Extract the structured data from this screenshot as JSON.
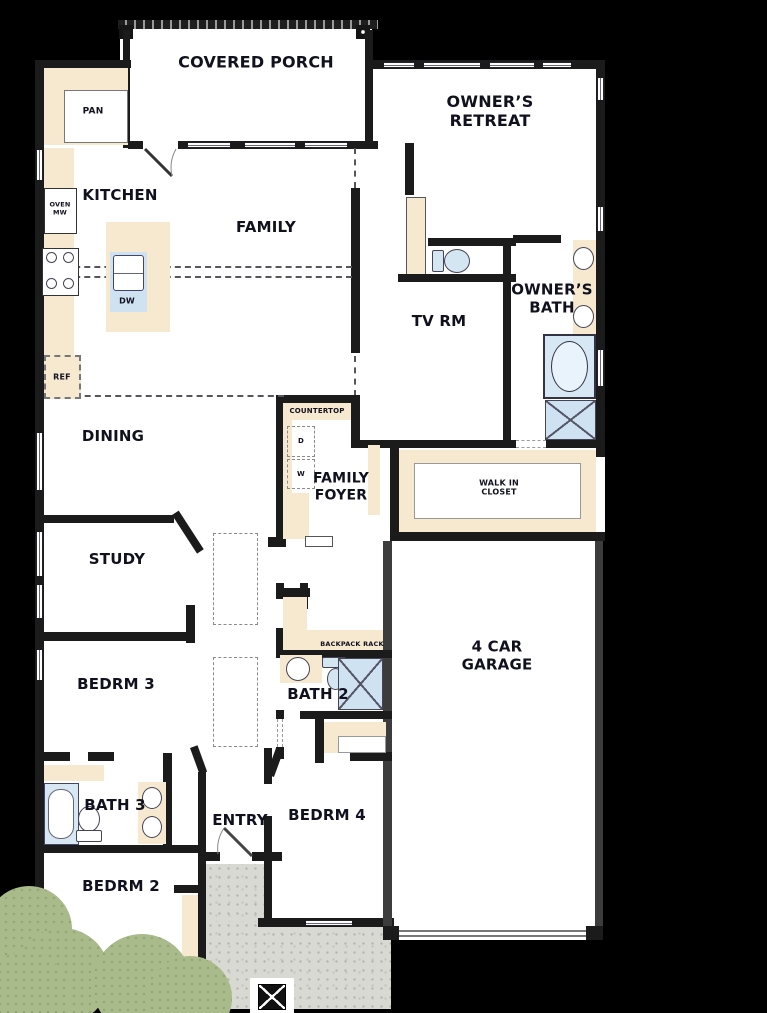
{
  "rooms": {
    "covered_porch": "COVERED PORCH",
    "owners_retreat": "OWNER’S\nRETREAT",
    "kitchen": "KITCHEN",
    "family": "FAMILY",
    "tv_rm": "TV RM",
    "owners_bath": "OWNER’S\nBATH",
    "dining": "DINING",
    "family_foyer": "FAMILY\nFOYER",
    "walk_in_closet": "WALK IN\nCLOSET",
    "study": "STUDY",
    "bedrm_3": "BEDRM 3",
    "bath_2": "BATH 2",
    "garage": "4 CAR\nGARAGE",
    "bath_3": "BATH 3",
    "entry": "ENTRY",
    "bedrm_4": "BEDRM 4",
    "bedrm_2": "BEDRM 2"
  },
  "fixtures": {
    "pantry": "PAN",
    "oven_mw": "OVEN\nMW",
    "dishwasher": "DW",
    "refrigerator": "REF",
    "countertop": "COUNTERTOP",
    "dryer": "D",
    "washer": "W",
    "backpack_rack": "BACKPACK RACK"
  },
  "colors": {
    "background": "#000000",
    "wall": "#1b1b1b",
    "floor": "#ffffff",
    "counter_cream": "#f6e9cf",
    "fixture_blue": "#cfe2f2",
    "concrete": "#d9d9d4",
    "shrub_green": "#a9ba8b"
  }
}
